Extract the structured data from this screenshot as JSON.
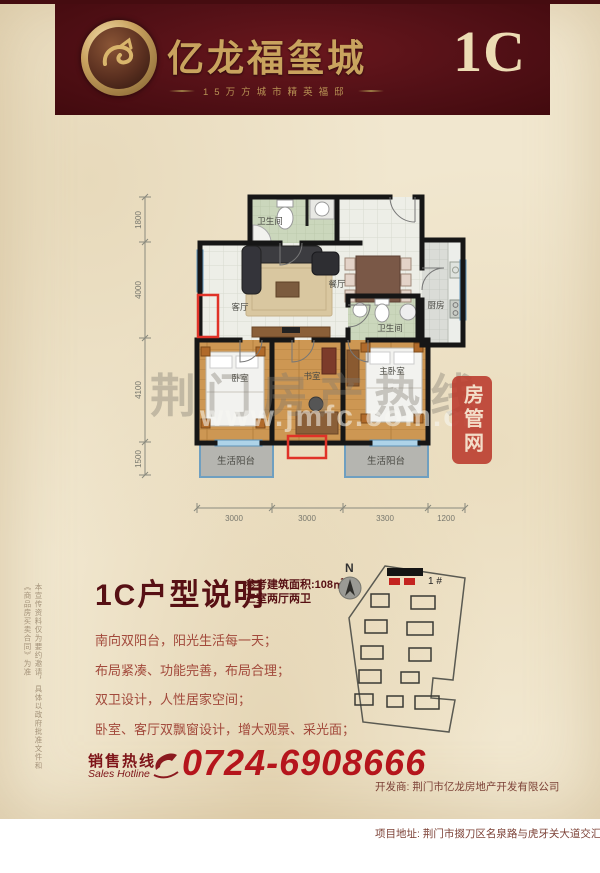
{
  "header": {
    "title": "亿龙福玺城",
    "tagline": "15万方城市精英福邸",
    "unit_code": "1C"
  },
  "plan": {
    "rooms": {
      "bath_top": "卫生间",
      "living": "客厅",
      "dining": "餐厅",
      "kitchen": "厨房",
      "bath_mid": "卫生间",
      "bedroom": "卧室",
      "study": "书室",
      "master": "主卧室",
      "balcony": "生活阳台"
    },
    "dims_left": [
      "1800",
      "4000",
      "4100",
      "1500"
    ],
    "dims_bottom": [
      "3000",
      "3000",
      "3300",
      "1200"
    ],
    "watermark_cn": "荆门房产热线",
    "watermark_url": "www.jmfc.com.cn",
    "seal": "房管网"
  },
  "description": {
    "title": "1C户型说明",
    "area_note": "参考建筑面积:108㎡",
    "layout_note": "三室两厅两卫",
    "bullets": "南向双阳台，阳光生活每一天；\n布局紧凑、功能完善，布局合理；\n双卫设计，人性居家空间；\n卧室、客厅双飘窗设计，增大观景、采光面；",
    "compass_label": "N",
    "site_building_label": "1 #"
  },
  "footer": {
    "hotline_cn": "销售热线",
    "hotline_en": "Sales Hotline",
    "phone": "0724-6908666",
    "developer": "开发商: 荆门市亿龙房地产开发有限公司",
    "address": "项目地址: 荆门市掇刀区名泉路与虎牙关大道交汇处"
  },
  "fine_print": "本宣传资料仅为要约邀请，具体以政府批准文件和《商品房买卖合同》为准"
}
